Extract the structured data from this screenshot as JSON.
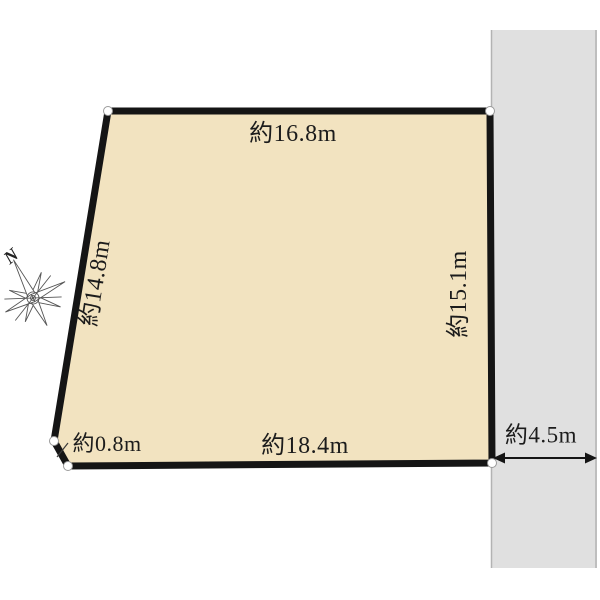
{
  "plot": {
    "fill_color": "#f2e3c0",
    "border_color": "#151515",
    "dimensions": {
      "top": "約16.8m",
      "right": "約15.1m",
      "bottom": "約18.4m",
      "left": "約14.8m",
      "corner": "約0.8m"
    }
  },
  "road": {
    "fill_color": "#e0e0e0",
    "edge_color": "#b3b3b3",
    "width_label": "約4.5m"
  },
  "compass": {
    "north_label": "N"
  }
}
